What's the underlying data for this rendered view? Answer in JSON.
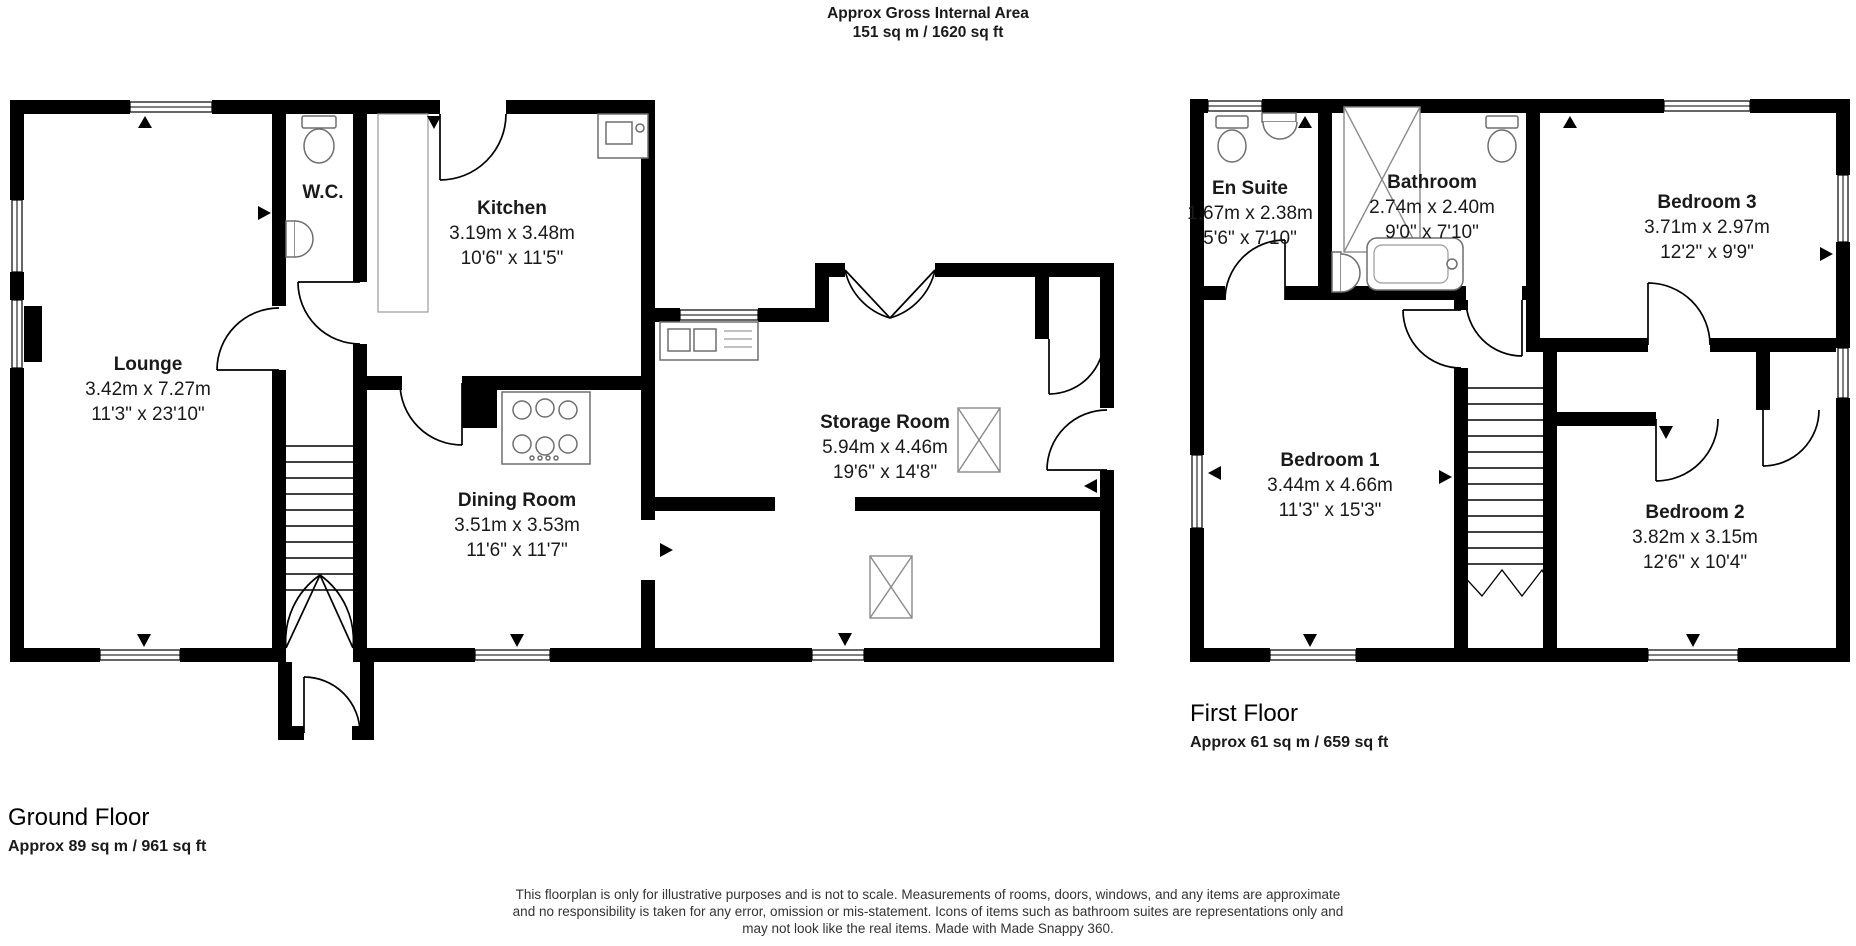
{
  "header": {
    "title_line1": "Approx Gross Internal Area",
    "title_line2": "151 sq m / 1620 sq ft"
  },
  "ground_floor": {
    "label": "Ground Floor",
    "area": "Approx 89 sq m / 961 sq ft",
    "rooms": [
      {
        "name": "Lounge",
        "metric": "3.42m x 7.27m",
        "imperial": "11'3\" x 23'10\""
      },
      {
        "name": "W.C.",
        "metric": "",
        "imperial": ""
      },
      {
        "name": "Kitchen",
        "metric": "3.19m x 3.48m",
        "imperial": "10'6\" x 11'5\""
      },
      {
        "name": "Dining Room",
        "metric": "3.51m x 3.53m",
        "imperial": "11'6\" x 11'7\""
      },
      {
        "name": "Storage Room",
        "metric": "5.94m x 4.46m",
        "imperial": "19'6\" x 14'8\""
      }
    ]
  },
  "first_floor": {
    "label": "First Floor",
    "area": "Approx 61 sq m / 659 sq ft",
    "rooms": [
      {
        "name": "En Suite",
        "metric": "1.67m x 2.38m",
        "imperial": "5'6\" x 7'10\""
      },
      {
        "name": "Bathroom",
        "metric": "2.74m x 2.40m",
        "imperial": "9'0\" x 7'10\""
      },
      {
        "name": "Bedroom 3",
        "metric": "3.71m x 2.97m",
        "imperial": "12'2\" x 9'9\""
      },
      {
        "name": "Bedroom 1",
        "metric": "3.44m x 4.66m",
        "imperial": "11'3\" x 15'3\""
      },
      {
        "name": "Bedroom 2",
        "metric": "3.82m x 3.15m",
        "imperial": "12'6\" x 10'4\""
      }
    ]
  },
  "disclaimer": {
    "line1": "This floorplan is only for illustrative purposes and is not to scale. Measurements of rooms, doors, windows, and any items are approximate",
    "line2": "and no responsibility is taken for any error, omission or mis-statement. Icons of items such as bathroom suites are representations only and",
    "line3": "may not look like the real items. Made with Made Snappy 360."
  },
  "colors": {
    "wall": "#000000",
    "fixture": "#6e6e6e",
    "text": "#1a1a1a"
  }
}
